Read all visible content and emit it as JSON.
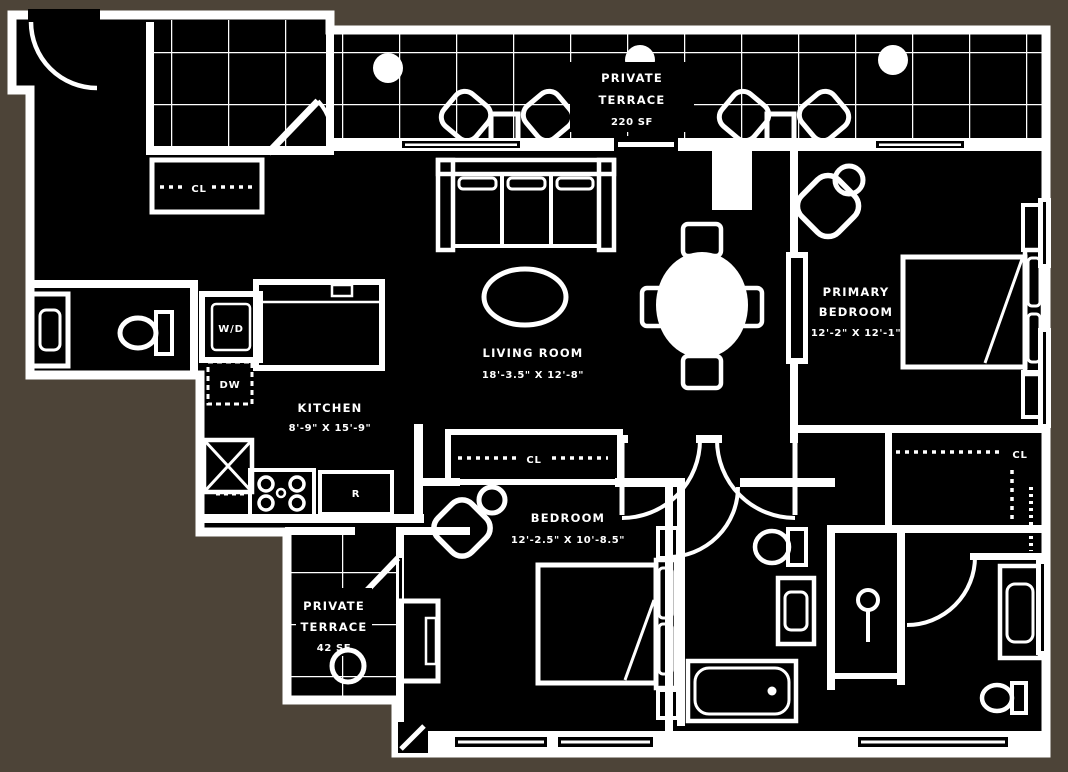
{
  "colors": {
    "surround_background": "#4d4438",
    "plan_background": "#000000",
    "line_color": "#ffffff"
  },
  "labels": {
    "terrace_top": {
      "line1": "PRIVATE",
      "line2": "TERRACE",
      "area": "220 SF"
    },
    "terrace_small": {
      "line1": "PRIVATE",
      "line2": "TERRACE",
      "area": "42 SF"
    },
    "living_room": {
      "name": "LIVING ROOM",
      "dims": "18'-3.5\" X 12'-8\""
    },
    "kitchen": {
      "name": "KITCHEN",
      "dims": "8'-9\" X 15'-9\""
    },
    "primary_bedroom": {
      "line1": "PRIMARY",
      "line2": "BEDROOM",
      "dims": "12'-2\" X 12'-1\""
    },
    "bedroom": {
      "name": "BEDROOM",
      "dims": "12'-2.5\" X 10'-8.5\""
    },
    "closet_entry": "CL",
    "closet_hall": "CL",
    "closet_primary": "CL",
    "washer_dryer": "W/D",
    "dishwasher": "DW",
    "refrigerator": "R"
  }
}
